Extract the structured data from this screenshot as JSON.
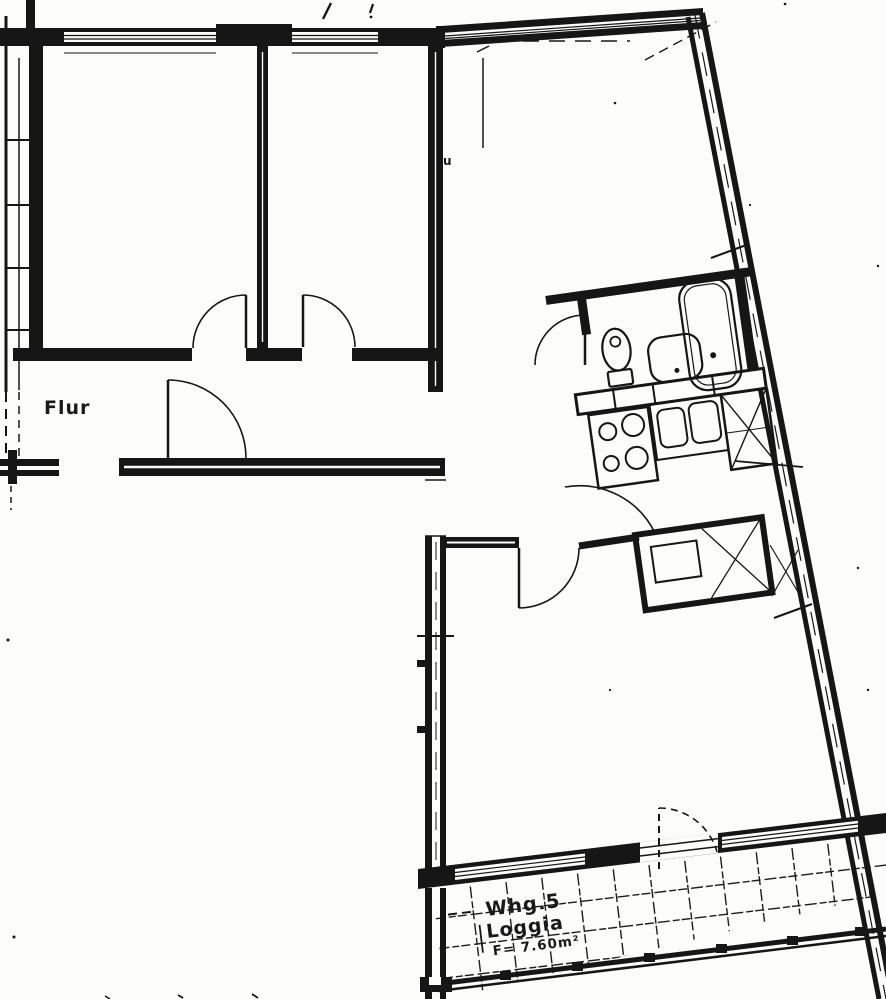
{
  "meta": {
    "document_type": "scanned apartment floor plan",
    "paper_color": "#fcfcfb",
    "ink_color": "#161616"
  },
  "labels": {
    "hallway": "Flur",
    "wall_mark": "u",
    "apartment": "Whg.5",
    "loggia": "Loggia",
    "loggia_area": "F= 7.60m²"
  },
  "fixtures": {
    "bathroom": [
      "toilet",
      "washbasin",
      "bathtub"
    ],
    "kitchen": [
      "stove-4-burners",
      "double-sink",
      "ventilation-shaft"
    ],
    "loggia": [
      "tile-floor",
      "railing-with-posts"
    ]
  }
}
